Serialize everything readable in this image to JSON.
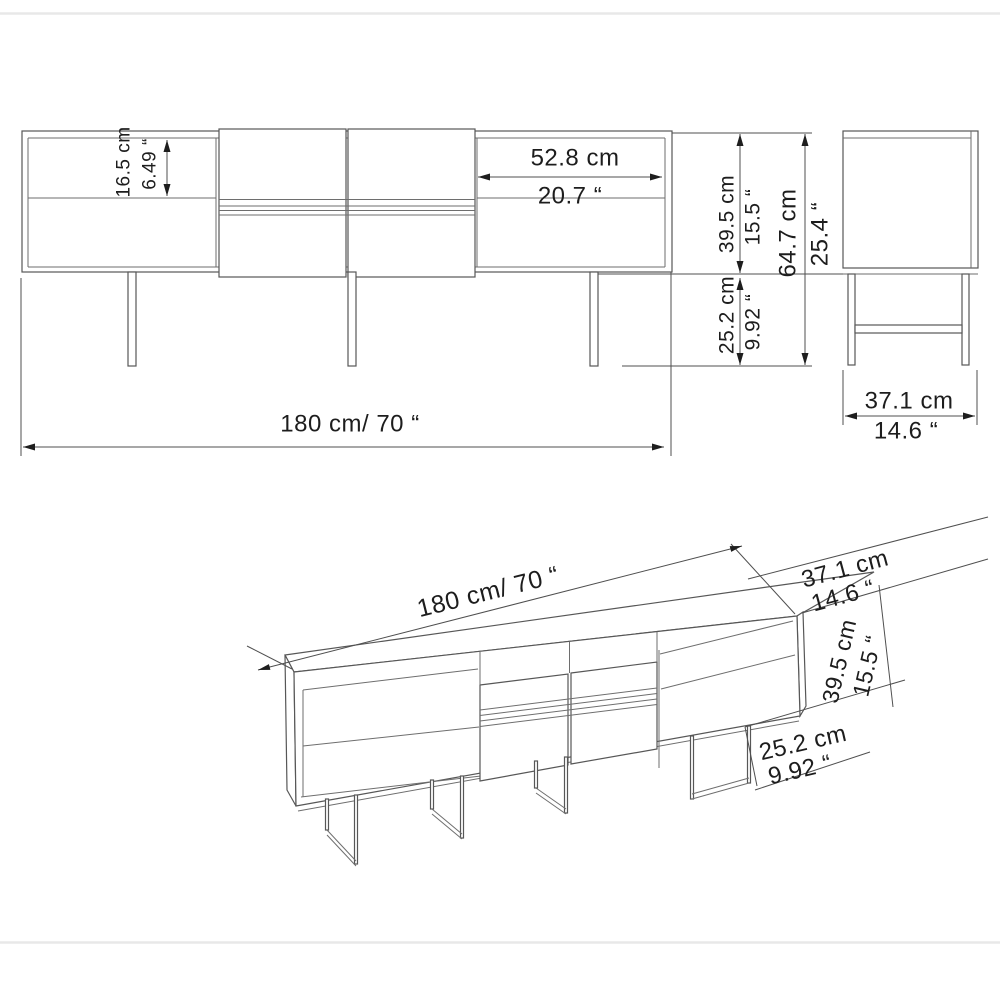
{
  "document": {
    "type": "furniture dimension drawing",
    "product": "TV stand / sideboard technical diagram",
    "line_color": "#575757",
    "text_color": "#1d1d1d",
    "frame_color": "#e8e8e8"
  },
  "front_view": {
    "shelf_cm": "16.5 cm",
    "shelf_in": "6.49 “",
    "inner_width_cm": "52.8 cm",
    "inner_width_in": "20.7 “",
    "body_height_cm": "39.5 cm",
    "body_height_in": "15.5 “",
    "leg_height_cm": "25.2 cm",
    "leg_height_in": "9.92 “",
    "total_height_cm": "64.7 cm",
    "total_height_in": "25.4 “",
    "total_width": "180 cm/ 70 “"
  },
  "side_view": {
    "depth_cm": "37.1 cm",
    "depth_in": "14.6 “"
  },
  "perspective_view": {
    "total_width": "180 cm/ 70 “",
    "depth_cm": "37.1 cm",
    "depth_in": "14.6 “",
    "body_height_cm": "39.5 cm",
    "body_height_in": "15.5 “",
    "leg_height_cm": "25.2 cm",
    "leg_height_in": "9.92 “"
  }
}
